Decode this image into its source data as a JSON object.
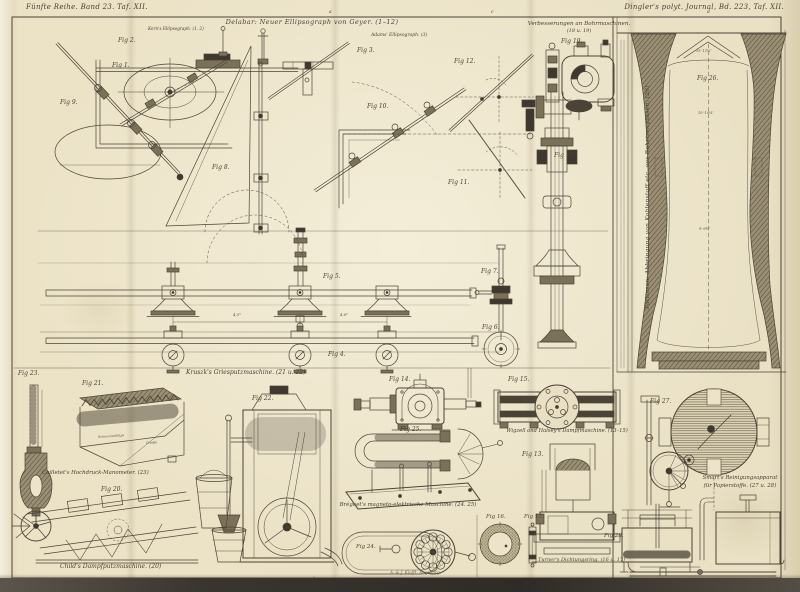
{
  "plate": {
    "header_left": "Fünfte Reihe. Band 23. Taf. XII.",
    "header_right": "Dingler's polyt. Journal, Bd. 223, Taf. XII.",
    "imprint": "A. & J. Klafft, Augsburg."
  },
  "marks": {
    "top_a": "a",
    "top_c": "c",
    "top_d": "d",
    "bot_a": "a",
    "bot_b": "b",
    "bot_c": "c"
  },
  "captions": {
    "ellipsograph_title": "Delabar: Neuer Ellipsograph von Geyer. (1–12)",
    "kern": "Kern's Ellipsograph. (1. 2)",
    "adams": "Adams' Ellipsograph. (3)",
    "bohr1": "Verbesserungen an Bohrmaschinen.",
    "bohr2": "(18 u. 19)",
    "pattinson": "Pattinson: Abbringung von Kohlenstoff etc. aus Roheisengüssen. (26)",
    "griesputz": "Kruszk's Griesputzmaschine. (21 u. 22)",
    "manometer": "Cailletet's Hochdruck-Manometer. (23)",
    "dampfputz": "Child's Dampfputzmaschine. (20)",
    "magneto": "Bréguet's magneto-elektrische Maschine. (24. 25)",
    "dampfmaschine": "Wigzell and Halsey's Dampfmaschine. (13–15)",
    "dichtungsring": "Turner's Dichtungsring. (16 u. 17)",
    "rein1": "Smart's Reinigungsapparat",
    "rein2": "für Papierstoffe. (27 u. 28)"
  },
  "figs": {
    "f1": "Fig 1.",
    "f2": "Fig 2.",
    "f3": "Fig 3.",
    "f4": "Fig 4.",
    "f5": "Fig 5.",
    "f6": "Fig 6.",
    "f7": "Fig 7.",
    "f8": "Fig 8.",
    "f9": "Fig 9.",
    "f10": "Fig 10.",
    "f11": "Fig 11.",
    "f12": "Fig 12.",
    "f13": "Fig 13.",
    "f14": "Fig 14.",
    "f15": "Fig 15.",
    "f16": "Fig 16.",
    "f17": "Fig 17.",
    "f18": "Fig 18.",
    "f19": "Fig 19.",
    "f20": "Fig 20.",
    "f21": "Fig 21.",
    "f22": "Fig 22.",
    "f23": "Fig 23.",
    "f24": "Fig 24.",
    "f25": "Fig 25.",
    "f26": "Fig 26.",
    "f27": "Fig 27.",
    "f28": "Fig 28."
  },
  "ann": {
    "dim_left": "4,5ᵐ",
    "dim_right": "4,6ᵐ",
    "f26_d1": "15′·11½″",
    "f26_d2": "10′·10¼″",
    "f26_d3": "9′·9½″",
    "f21_l": "Schwarzschläge",
    "f21_r": "Grieße"
  }
}
